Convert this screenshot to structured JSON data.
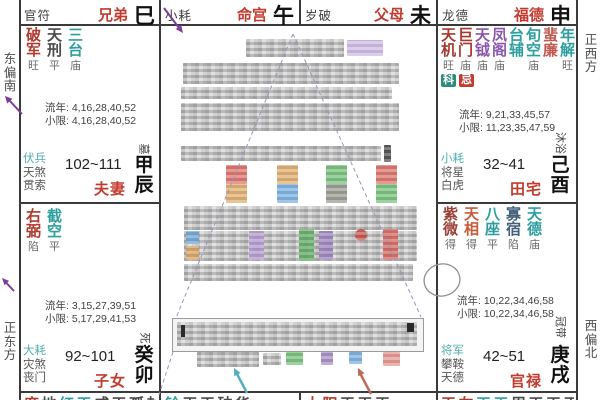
{
  "compass": {
    "east_south": "东偏南",
    "east": "正东方",
    "west": "正西方",
    "west_north": "西偏北"
  },
  "top_row": [
    {
      "god": "官符",
      "palace": "兄弟",
      "branch": "巳"
    },
    {
      "god": "小耗",
      "palace": "命宫",
      "branch": "午"
    },
    {
      "god": "岁破",
      "palace": "父母",
      "branch": "未"
    },
    {
      "god": "龙德",
      "palace": "福德",
      "branch": "申"
    }
  ],
  "left_palaces": [
    {
      "stars": [
        {
          "name": "破军",
          "state": "旺",
          "color": "#b0392e"
        },
        {
          "name": "天刑",
          "state": "平",
          "color": "#4a4a4a"
        },
        {
          "name": "三台",
          "state": "庙",
          "color": "#2f9e9e"
        }
      ],
      "liunian": "流年: 4,16,28,40,52",
      "xiaoxian": "小限: 4,16,28,40,52",
      "gods": [
        {
          "t": "伏兵",
          "color": "#52b0ae"
        },
        {
          "t": "天煞",
          "color": "#555555"
        },
        {
          "t": "贯索",
          "color": "#555555"
        }
      ],
      "range": "102~111",
      "name": "夫妻",
      "changsheng": "墓",
      "ganzhi": "甲辰"
    },
    {
      "stars": [
        {
          "name": "右弼",
          "state": "陷",
          "color": "#b0392e"
        },
        {
          "name": "截空",
          "state": "平",
          "color": "#2f9e9e"
        }
      ],
      "liunian": "流年: 3,15,27,39,51",
      "xiaoxian": "小限: 5,17,29,41,53",
      "gods": [
        {
          "t": "大耗",
          "color": "#52b0ae"
        },
        {
          "t": "灾煞",
          "color": "#555555"
        },
        {
          "t": "丧门",
          "color": "#555555"
        }
      ],
      "range": "92~101",
      "name": "子女",
      "changsheng": "死",
      "ganzhi": "癸卯"
    }
  ],
  "right_palaces": [
    {
      "stars": [
        {
          "name": "天机",
          "state": "旺",
          "color": "#a8382f"
        },
        {
          "name": "巨门",
          "state": "庙",
          "color": "#a8382f"
        },
        {
          "name": "天钺",
          "state": "庙",
          "color": "#8a56ad"
        },
        {
          "name": "凤阁",
          "state": "庙",
          "color": "#8a56ad"
        },
        {
          "name": "台辅",
          "state": "",
          "color": "#2f9e9e"
        },
        {
          "name": "旬空",
          "state": "庙",
          "color": "#2f9e9e"
        },
        {
          "name": "蜚廉",
          "state": "",
          "color": "#c05a50"
        },
        {
          "name": "年解",
          "state": "旺",
          "color": "#2f9e9e"
        }
      ],
      "badges": [
        {
          "label": "科",
          "bg": "#2e8b7a"
        },
        {
          "label": "忌",
          "bg": "#c23b2e"
        }
      ],
      "liunian": "流年: 9,21,33,45,57",
      "xiaoxian": "小限: 11,23,35,47,59",
      "gods": [
        {
          "t": "小耗",
          "color": "#52b0ae"
        },
        {
          "t": "将星",
          "color": "#555555"
        },
        {
          "t": "白虎",
          "color": "#555555"
        }
      ],
      "range": "32~41",
      "name": "田宅",
      "changsheng": "沐浴",
      "ganzhi": "己酉"
    },
    {
      "stars": [
        {
          "name": "紫微",
          "state": "得",
          "color": "#9a4038"
        },
        {
          "name": "天相",
          "state": "得",
          "color": "#c85a3a"
        },
        {
          "name": "八座",
          "state": "平",
          "color": "#2f9e9e"
        },
        {
          "name": "寡宿",
          "state": "陷",
          "color": "#44607a"
        },
        {
          "name": "天德",
          "state": "庙",
          "color": "#2f9e9e"
        }
      ],
      "liunian": "流年: 10,22,34,46,58",
      "xiaoxian": "小限: 10,22,34,46,58",
      "gods": [
        {
          "t": "将军",
          "color": "#52b0ae"
        },
        {
          "t": "攀鞍",
          "color": "#555555"
        },
        {
          "t": "天德",
          "color": "#555555"
        }
      ],
      "range": "42~51",
      "name": "官禄",
      "changsheng": "冠带",
      "ganzhi": "庚戌"
    }
  ],
  "bottom_row": [
    {
      "segs": [
        {
          "text": "廉",
          "color": "#b0392e"
        },
        {
          "text": "地",
          "color": "#4a4a4a"
        },
        {
          "text": "红天",
          "color": "#2f9e9e"
        },
        {
          "text": "咸天孤封",
          "color": "#4a4a4a"
        }
      ]
    },
    {
      "segs": [
        {
          "text": "铃",
          "color": "#2f9e9e"
        },
        {
          "text": "天天破华",
          "color": "#4a4a4a"
        }
      ]
    },
    {
      "segs": [
        {
          "text": "太阳",
          "color": "#b0392e"
        },
        {
          "text": "天天天",
          "color": "#4a4a4a"
        }
      ]
    },
    {
      "segs": [
        {
          "text": "天左",
          "color": "#b0392e"
        },
        {
          "text": "天天",
          "color": "#2f9e9e"
        },
        {
          "text": "周天天天天",
          "color": "#4a4a4a"
        }
      ]
    }
  ]
}
